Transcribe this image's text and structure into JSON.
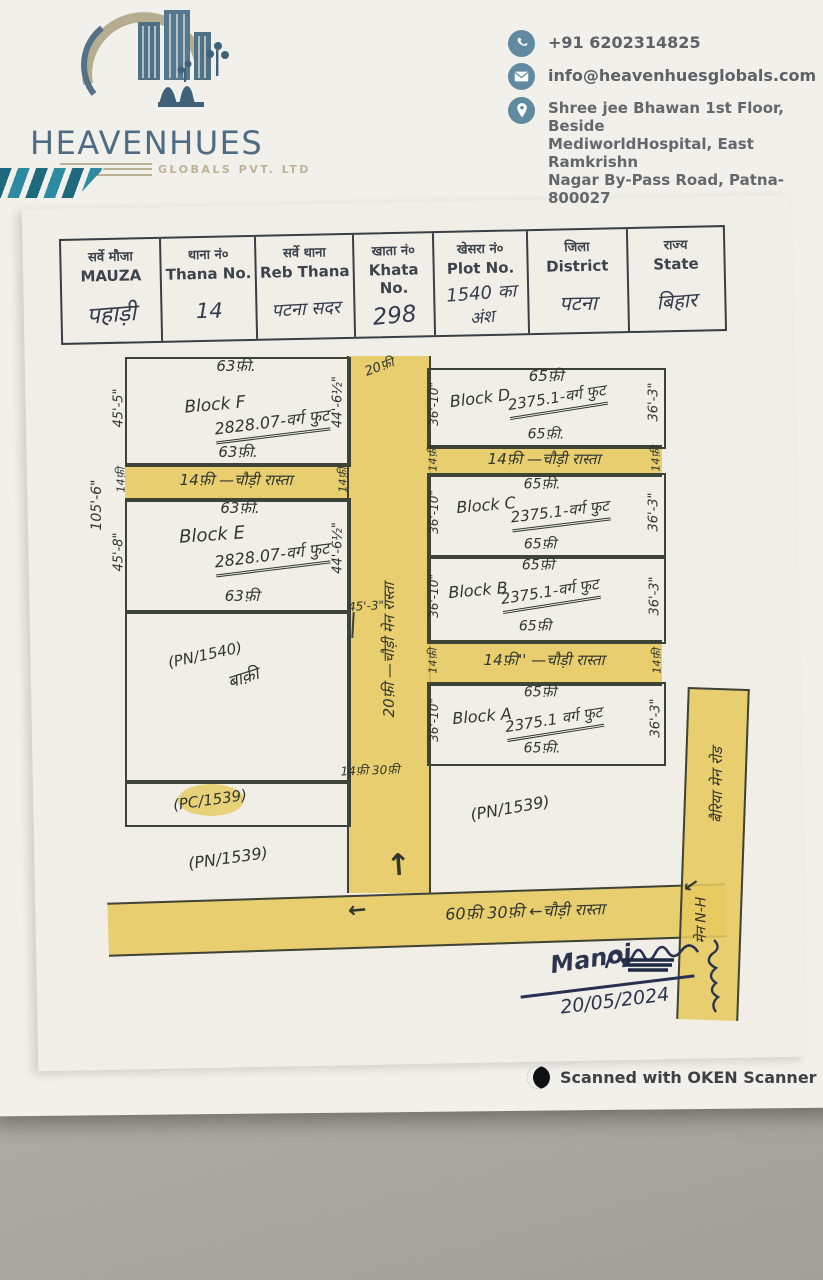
{
  "letterhead": {
    "brand_name": "HEAVENHUES",
    "brand_subtitle": "GLOBALS PVT. LTD",
    "phone": "+91 6202314825",
    "email": "info@heavenhuesglobals.com",
    "address_line1": "Shree jee Bhawan 1st Floor, Beside",
    "address_line2": "MediworldHospital, East Ramkrishn",
    "address_line3": "Nagar By-Pass Road, Patna-800027"
  },
  "table": {
    "columns": [
      {
        "hi": "सर्वे मौजा",
        "en": "MAUZA",
        "value": "पहाड़ी"
      },
      {
        "hi": "थाना नं०",
        "en": "Thana No.",
        "value": "14"
      },
      {
        "hi": "सर्वे थाना",
        "en": "Reb Thana",
        "value": "पटना सदर"
      },
      {
        "hi": "खाता नं०",
        "en": "Khata No.",
        "value": "298"
      },
      {
        "hi": "खेसरा नं०",
        "en": "Plot No.",
        "value": "1540 का",
        "value2": "अंश"
      },
      {
        "hi": "जिला",
        "en": "District",
        "value": "पटना"
      },
      {
        "hi": "राज्य",
        "en": "State",
        "value": "बिहार"
      }
    ]
  },
  "map": {
    "blocks": [
      {
        "name": "Block F",
        "area": "2828.07-वर्ग फुट",
        "top": "63फ़ी.",
        "bottom": "63फ़ी.",
        "left": "45'-5\"",
        "right": "44'-6½\""
      },
      {
        "name": "Block E",
        "area": "2828.07-वर्ग फुट",
        "top": "63फ़ी.",
        "bottom": "63फ़ी",
        "left": "45'-8\"",
        "right": "44'-6½\""
      },
      {
        "name": "Block D",
        "area": "2375.1-वर्ग फुट",
        "top": "65फ़ी",
        "bottom": "65फ़ी.",
        "left": "36'-10\"",
        "right": "36'-3\""
      },
      {
        "name": "Block C",
        "area": "2375.1-वर्ग फुट",
        "top": "65फ़ी.",
        "bottom": "65फ़ी",
        "left": "36'-10\"",
        "right": "36'-3\""
      },
      {
        "name": "Block B",
        "area": "2375.1-वर्ग फुट",
        "top": "65फ़ी",
        "bottom": "65फ़ी",
        "left": "36'-10\"",
        "right": "36'-3\""
      },
      {
        "name": "Block A",
        "area": "2375.1 वर्ग फुट",
        "top": "65फ़ी",
        "bottom": "65फ़ी.",
        "left": "36'-10\"",
        "right": "36'-3\""
      }
    ],
    "cross_roads": [
      {
        "label": "14फ़ी —चौड़ी रास्ता",
        "left_end": "14फ़ी",
        "right_end": "14फ़ी"
      },
      {
        "label": "14फ़ी —चौड़ी रास्ता",
        "left_end": "14फ़ी",
        "right_end": "14फ़ी"
      },
      {
        "label": "14फ़ी'' —चौड़ी रास्ता",
        "left_end": "14फ़ी",
        "right_end": "14फ़ी"
      }
    ],
    "main_road": {
      "label": "20फ़ी —चौड़ी मेन रास्ता",
      "top_label": "20फ़ी"
    },
    "bottom_road": {
      "label": "60फ़ी  30फ़ी ←चौड़ी रास्ता"
    },
    "right_road": {
      "label": "बैरिया मेन रोड",
      "label2": "मेन N-H"
    },
    "parcels": {
      "pn1540_label": "(PN/1540)",
      "pn1540_note": "बाक़ी",
      "pc1539": "(PC/1539)",
      "pn1539_left": "(PN/1539)",
      "pn1539_right": "(PN/1539)"
    },
    "outer_dims": {
      "left": "105'-6\"",
      "below_e": "45'-3\"",
      "junction": "14फ़ी  30फ़ी"
    }
  },
  "signature": {
    "name": "Manoj",
    "date": "20/05/2024"
  },
  "footer": {
    "scanner": "Scanned with OKEN Scanner"
  },
  "colors": {
    "road_highlight": "#e6ca5e",
    "brand_teal": "#1e6a7c",
    "brand_blue": "#4e6d85",
    "paper": "#f1efe9"
  }
}
